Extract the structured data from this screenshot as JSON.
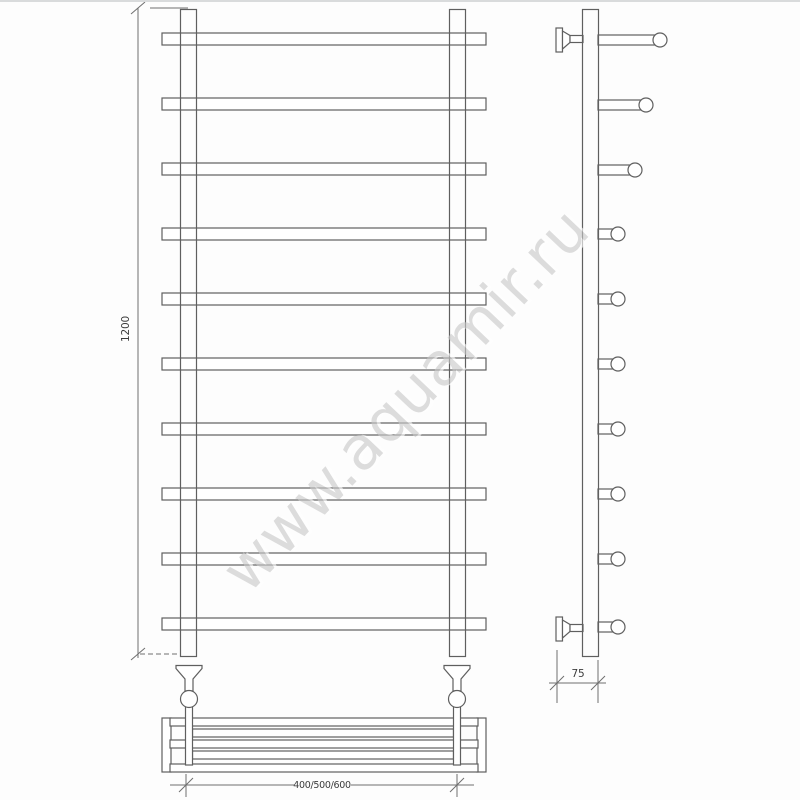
{
  "watermark": {
    "text": "www.aquamir.ru"
  },
  "dimensions": {
    "height": "1200",
    "width_options": "400/500/600",
    "depth": "75"
  },
  "front_view": {
    "rung_count": 10,
    "post_count": 2,
    "valve_count": 2,
    "shelf_bar_count": 5
  },
  "side_view": {
    "rung_count": 10,
    "wall_bracket_count": 2
  },
  "colors": {
    "line": "#5f5f5f",
    "dim_line": "#6e6e6e",
    "text": "#3c3c3c",
    "watermark": "#c9c9c9",
    "background": "#fdfdfd"
  }
}
